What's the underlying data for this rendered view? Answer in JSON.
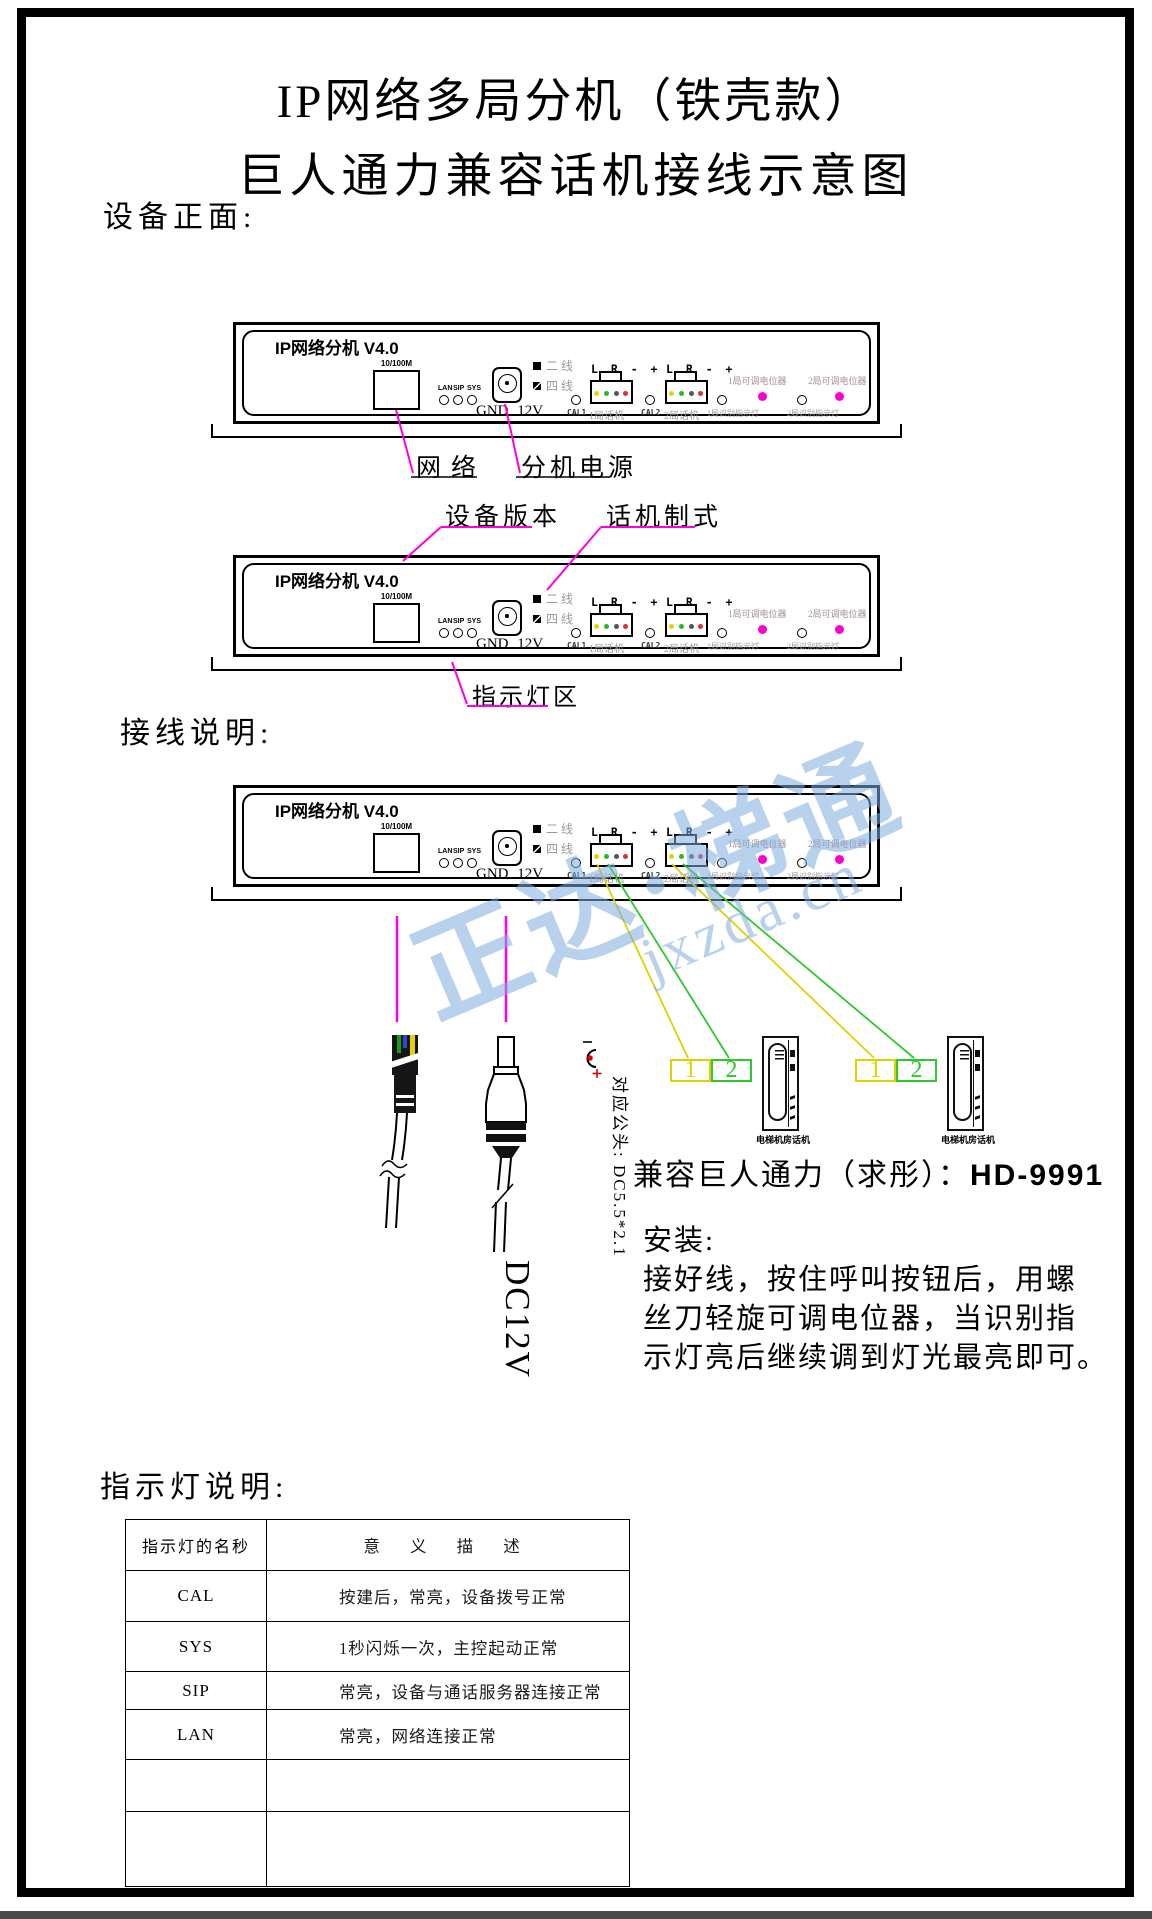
{
  "page": {
    "title_line1": "IP网络多局分机（铁壳款）",
    "title_line2": "巨人通力兼容话机接线示意图",
    "section_front": "设备正面:",
    "section_wiring": "接线说明:",
    "section_leds": "指示灯说明:"
  },
  "device": {
    "model": "IP网络分机 V4.0",
    "port": "10/100M",
    "led1": "LAN",
    "led2": "SIP",
    "led3": "SYS",
    "gnd": "GND 12V",
    "two_wire": "二 线",
    "four_wire": "四 线",
    "pins": "L R - +",
    "cal1": "CAL1",
    "cal2": "CAL2",
    "phone1": "1局话机",
    "phone2": "2局话机",
    "pot1": "1局可调电位器",
    "pot2": "2局可调电位器",
    "id1": "1局识别指示灯",
    "id2": "2局识别指示灯"
  },
  "annotations": {
    "network": "网络",
    "power": "分机电源",
    "version": "设备版本",
    "phone_mode": "话机制式",
    "led_zone": "指示灯区"
  },
  "wiring": {
    "plug_note": "对应公头: DC5.5*2.1",
    "dc_label": "DC12V",
    "terminal1": "1",
    "terminal2": "2",
    "phone_label": "电梯机房话机",
    "compat_text": "兼容巨人通力（求彤）：",
    "compat_model": "HD-9991",
    "install_title": "安装:",
    "install_line1": "接好线，按住呼叫按钮后，用螺",
    "install_line2": "丝刀轻旋可调电位器，当识别指",
    "install_line3": "示灯亮后继续调到灯光最亮即可。"
  },
  "led_table": {
    "header_name": "指示灯的名秒",
    "header_desc": "意 义 描 述",
    "rows": [
      {
        "name": "CAL",
        "desc": "按建后，常亮，设备拨号正常"
      },
      {
        "name": "SYS",
        "desc": "1秒闪烁一次，主控起动正常"
      },
      {
        "name": "SIP",
        "desc": "常亮，设备与通话服务器连接正常"
      },
      {
        "name": "LAN",
        "desc": "常亮，网络连接正常"
      },
      {
        "name": "",
        "desc": ""
      },
      {
        "name": "",
        "desc": ""
      }
    ]
  },
  "watermark": {
    "text": "正达·梯通",
    "url": "jxzda.cn"
  },
  "colors": {
    "leader": "#ff00dd",
    "wire_yellow": "#ddd200",
    "wire_green": "#2ec82e",
    "pin_yellow": "#e6d400",
    "pin_green": "#22bb22",
    "pin_dark": "#555555",
    "pin_red": "#e03030",
    "pot_dot": "#ff00cc"
  }
}
